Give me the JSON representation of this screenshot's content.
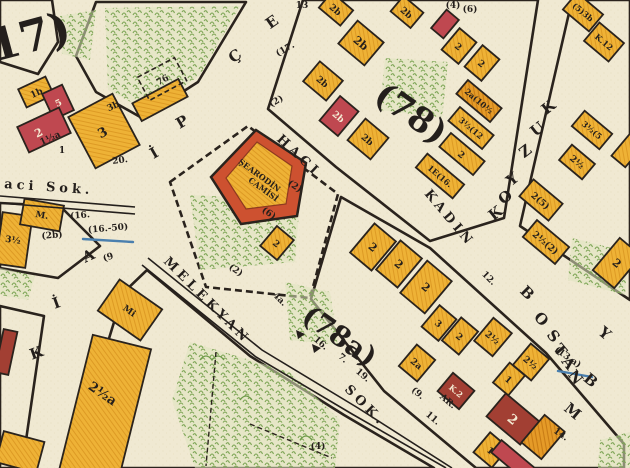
{
  "colors": {
    "paper": "#f0e9d2",
    "ink": "#2a231d",
    "parcel_yellow": "#eeb236",
    "parcel_orange": "#e59b28",
    "parcel_red": "#bf4850",
    "parcel_darkred": "#a23f33",
    "mosque_red": "#cd5130",
    "vegetation_green": "#7ca454",
    "water_blue": "#4a7fae"
  },
  "block_numbers": {
    "b17": "17)",
    "b78": "(78)",
    "b78a": "(78a)"
  },
  "street_names": {
    "aci_sok": "aci Sok.",
    "melekyan": "MELEKYAN",
    "sok": "SOK.",
    "haci": "HACI",
    "kadin": "KADIN",
    "bostan_letters": [
      "B",
      "O",
      "S",
      "T",
      "A",
      "N"
    ],
    "kuzu_letters": [
      "K",
      "U",
      "Z",
      "Y",
      "O",
      "K"
    ],
    "left_letters": [
      "E",
      "Ç",
      "P",
      "İ",
      "A",
      "İ",
      "K"
    ],
    "stray_letters": [
      "Y",
      "B",
      "M"
    ]
  },
  "mosque": {
    "line1": "ŞEARODİN",
    "line2": "CAMİSİ"
  },
  "plot76": "76",
  "parcels": [
    {
      "label": "1b"
    },
    {
      "label": "5"
    },
    {
      "label": "2"
    },
    {
      "label": "3"
    },
    {
      "label": "3½"
    },
    {
      "label": "M."
    },
    {
      "label": "Mi"
    },
    {
      "label": "2½a"
    },
    {
      "label": "2"
    },
    {
      "label": "2b"
    },
    {
      "label": "2b"
    },
    {
      "label": "2b"
    },
    {
      "label": "2b"
    },
    {
      "label": "2b"
    },
    {
      "label": "2b"
    },
    {
      "label": "2"
    },
    {
      "label": "2"
    },
    {
      "label": "2a(10½"
    },
    {
      "label": "3½(12"
    },
    {
      "label": "2"
    },
    {
      "label": "1E(16."
    },
    {
      "label": "(5)3b"
    },
    {
      "label": "K.12"
    },
    {
      "label": "3½(5"
    },
    {
      "label": "2½"
    },
    {
      "label": "2(5)"
    },
    {
      "label": "2½(2)"
    },
    {
      "label": "2"
    },
    {
      "label": "2"
    },
    {
      "label": "2"
    },
    {
      "label": "2"
    },
    {
      "label": "3"
    },
    {
      "label": "2"
    },
    {
      "label": "2½"
    },
    {
      "label": "2½"
    },
    {
      "label": "1"
    },
    {
      "label": "2a"
    },
    {
      "label": "K.2"
    },
    {
      "label": "2"
    },
    {
      "label": "1"
    }
  ],
  "annotations": [
    {
      "text": "20."
    },
    {
      "text": "(16.-50)"
    },
    {
      "text": "(2b)"
    },
    {
      "text": "(9"
    },
    {
      "text": "1"
    },
    {
      "text": "(17."
    },
    {
      "text": "(2)"
    },
    {
      "text": "13"
    },
    {
      "text": "(4)"
    },
    {
      "text": "(6)"
    },
    {
      "text": "(6)"
    },
    {
      "text": "(2)"
    },
    {
      "text": "(2)"
    },
    {
      "text": "12."
    },
    {
      "text": "16."
    },
    {
      "text": "7."
    },
    {
      "text": "19."
    },
    {
      "text": "11."
    },
    {
      "text": "(9."
    },
    {
      "text": "(13.a)"
    },
    {
      "text": "14."
    },
    {
      "text": "(4)"
    },
    {
      "text": "AR."
    },
    {
      "text": "3b"
    },
    {
      "text": "1½a"
    },
    {
      "text": "(16."
    },
    {
      "text": "4a."
    }
  ]
}
